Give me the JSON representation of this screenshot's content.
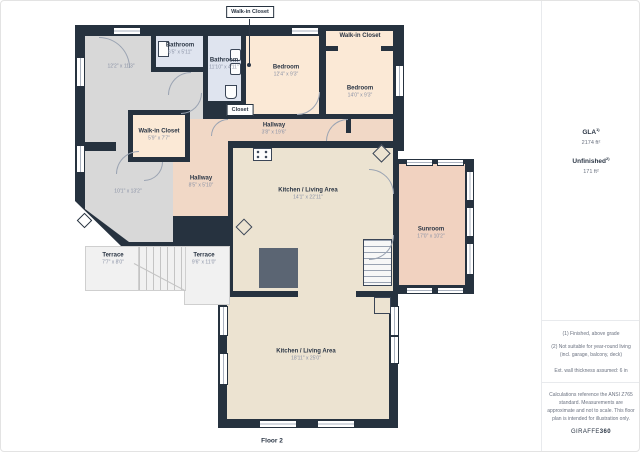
{
  "plan": {
    "floor_label": "Floor 2",
    "callouts": {
      "walk_in_closet": "Walk-in Closet",
      "closet": "Closet"
    },
    "rooms": {
      "room_top_left": {
        "dims": "12'2\" x 11'3\""
      },
      "bathroom1": {
        "name": "Bathroom",
        "dims": "6'5\" x 5'11\""
      },
      "bathroom2": {
        "name": "Bathroom",
        "dims": "11'10\" x 4'11\""
      },
      "bedroom1": {
        "name": "Bedroom",
        "dims": "12'4\" x 9'3\""
      },
      "wic_top_right": {
        "name": "Walk-in Closet"
      },
      "bedroom2": {
        "name": "Bedroom",
        "dims": "14'0\" x 9'3\""
      },
      "hallway1": {
        "name": "Hallway",
        "dims": "3'8\" x 19'6\""
      },
      "wic_left": {
        "name": "Walk-in Closet",
        "dims": "5'9\" x 7'7\""
      },
      "hallway2": {
        "name": "Hallway",
        "dims": "8'5\" x 5'10\""
      },
      "room_mid_left": {
        "dims": "10'1\" x 13'2\""
      },
      "kitchen_upper": {
        "name": "Kitchen / Living Area",
        "dims": "14'1\" x 22'11\""
      },
      "sunroom": {
        "name": "Sunroom",
        "dims": "17'0\" x 10'2\""
      },
      "terrace1": {
        "name": "Terrace",
        "dims": "7'7\" x 8'0\""
      },
      "terrace2": {
        "name": "Terrace",
        "dims": "9'6\" x 11'0\""
      },
      "kitchen_lower": {
        "name": "Kitchen / Living Area",
        "dims": "18'11\" x 25'0\""
      }
    }
  },
  "sidebar": {
    "gla_label": "GLA",
    "gla_sup": "1)",
    "gla_value": "2174 ft²",
    "unfinished_label": "Unfinished",
    "unfinished_sup": "2)",
    "unfinished_value": "171 ft²",
    "notes": [
      "(1) Finished, above grade",
      "(2) Not suitable for year-round living (incl. garage, balcony, deck)",
      "Ext. wall thickness assumed: 6 in"
    ],
    "disclaimer": "Calculations reference the ANSI Z765 standard. Measurements are approximate and not to scale. This floor plan is intended for illustration only.",
    "brand": {
      "name": "GIRAFFE",
      "suffix": "360"
    }
  },
  "colors": {
    "wall": "#26323f",
    "gray_room": "#d8d8d8",
    "bathroom": "#dfe4ef",
    "bedroom": "#fbe9d6",
    "hallway": "#f1d8c6",
    "living": "#ece3d1",
    "sunroom": "#f1d2c0",
    "terrace": "#f1f1f1",
    "text_dark": "#2b3645",
    "text_dim": "#8a92a6"
  }
}
